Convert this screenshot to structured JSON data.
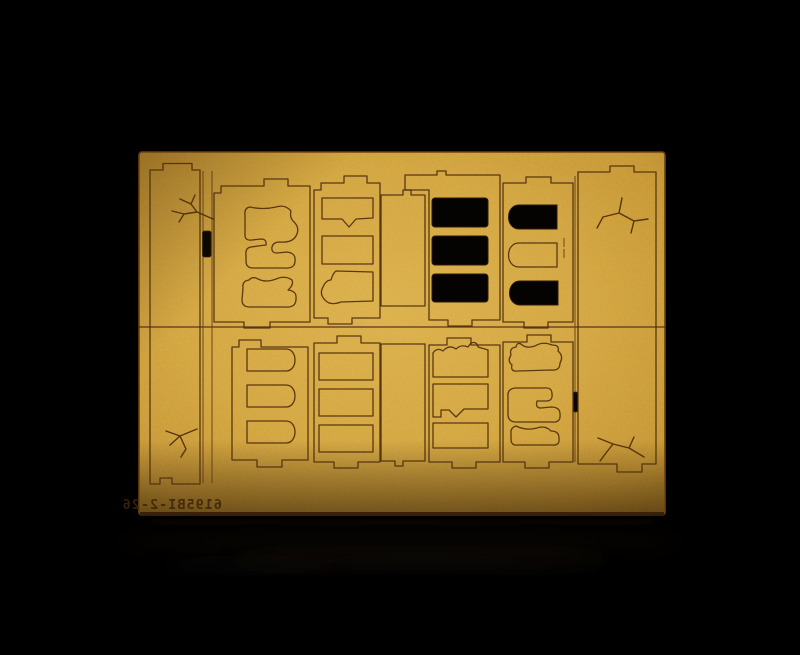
{
  "scene": {
    "subject": "laser-cut MDF model kit sheet on black background",
    "engraving": {
      "part_number": "6195BI-2-26",
      "mirrored": true
    },
    "colors": {
      "background": "#000000",
      "sheet_light": "#ddb04a",
      "sheet_mid": "#d2a23a",
      "sheet_dark": "#c3912e",
      "sheet_edge": "#a9791f",
      "cut_line": "#4f2f0c",
      "opening_hole": "#040302",
      "engraving": "#3f2406",
      "sheet_side": "#2e1b06"
    },
    "counts": {
      "removed_openings": 6,
      "wall_panels": 8,
      "edge_pieces": 4,
      "crack_engravings": 4
    }
  }
}
